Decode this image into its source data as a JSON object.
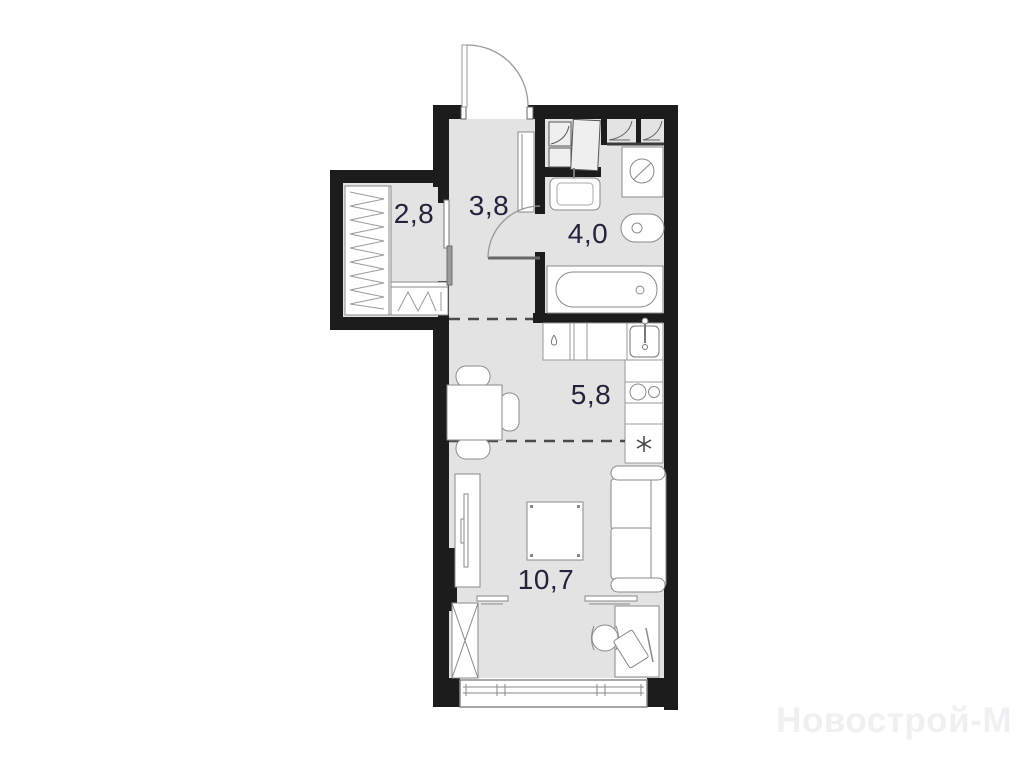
{
  "floorplan": {
    "type": "studio-apartment-plan",
    "rooms": [
      {
        "id": "wardrobe",
        "area_label": "2,8"
      },
      {
        "id": "hallway",
        "area_label": "3,8"
      },
      {
        "id": "bathroom",
        "area_label": "4,0"
      },
      {
        "id": "kitchen",
        "area_label": "5,8"
      },
      {
        "id": "living_room",
        "area_label": "10,7"
      }
    ],
    "fixtures": [
      "entry-door",
      "sliding-door",
      "wardrobe-rack",
      "wardrobe-shelf",
      "storage-shelves",
      "hall-cabinet",
      "washing-machine",
      "bathroom-sink",
      "toilet",
      "bathtub",
      "bathroom-door",
      "kitchen-counter",
      "kitchen-sink",
      "cooktop",
      "refrigerator",
      "dining-table",
      "chairs",
      "tv-stand",
      "coffee-table",
      "sofa",
      "wall-shelves",
      "x-wardrobe",
      "desk",
      "office-chair",
      "laptop",
      "window"
    ],
    "symbols": {
      "refrigerator": "snowflake-asterisk",
      "kitchen_cabinet": "water-drop"
    },
    "colors": {
      "wall": "#1c1c1c",
      "floor": "#e3e3e3",
      "furniture_fill": "#ffffff",
      "furniture_outline": "#8a8a8a",
      "thin_line": "#999999",
      "dashed_zone_line": "#4a4a4a",
      "label_text": "#23233c",
      "watermark_text": "#f0eff1"
    }
  },
  "watermark": {
    "text": "Новострой-М"
  }
}
